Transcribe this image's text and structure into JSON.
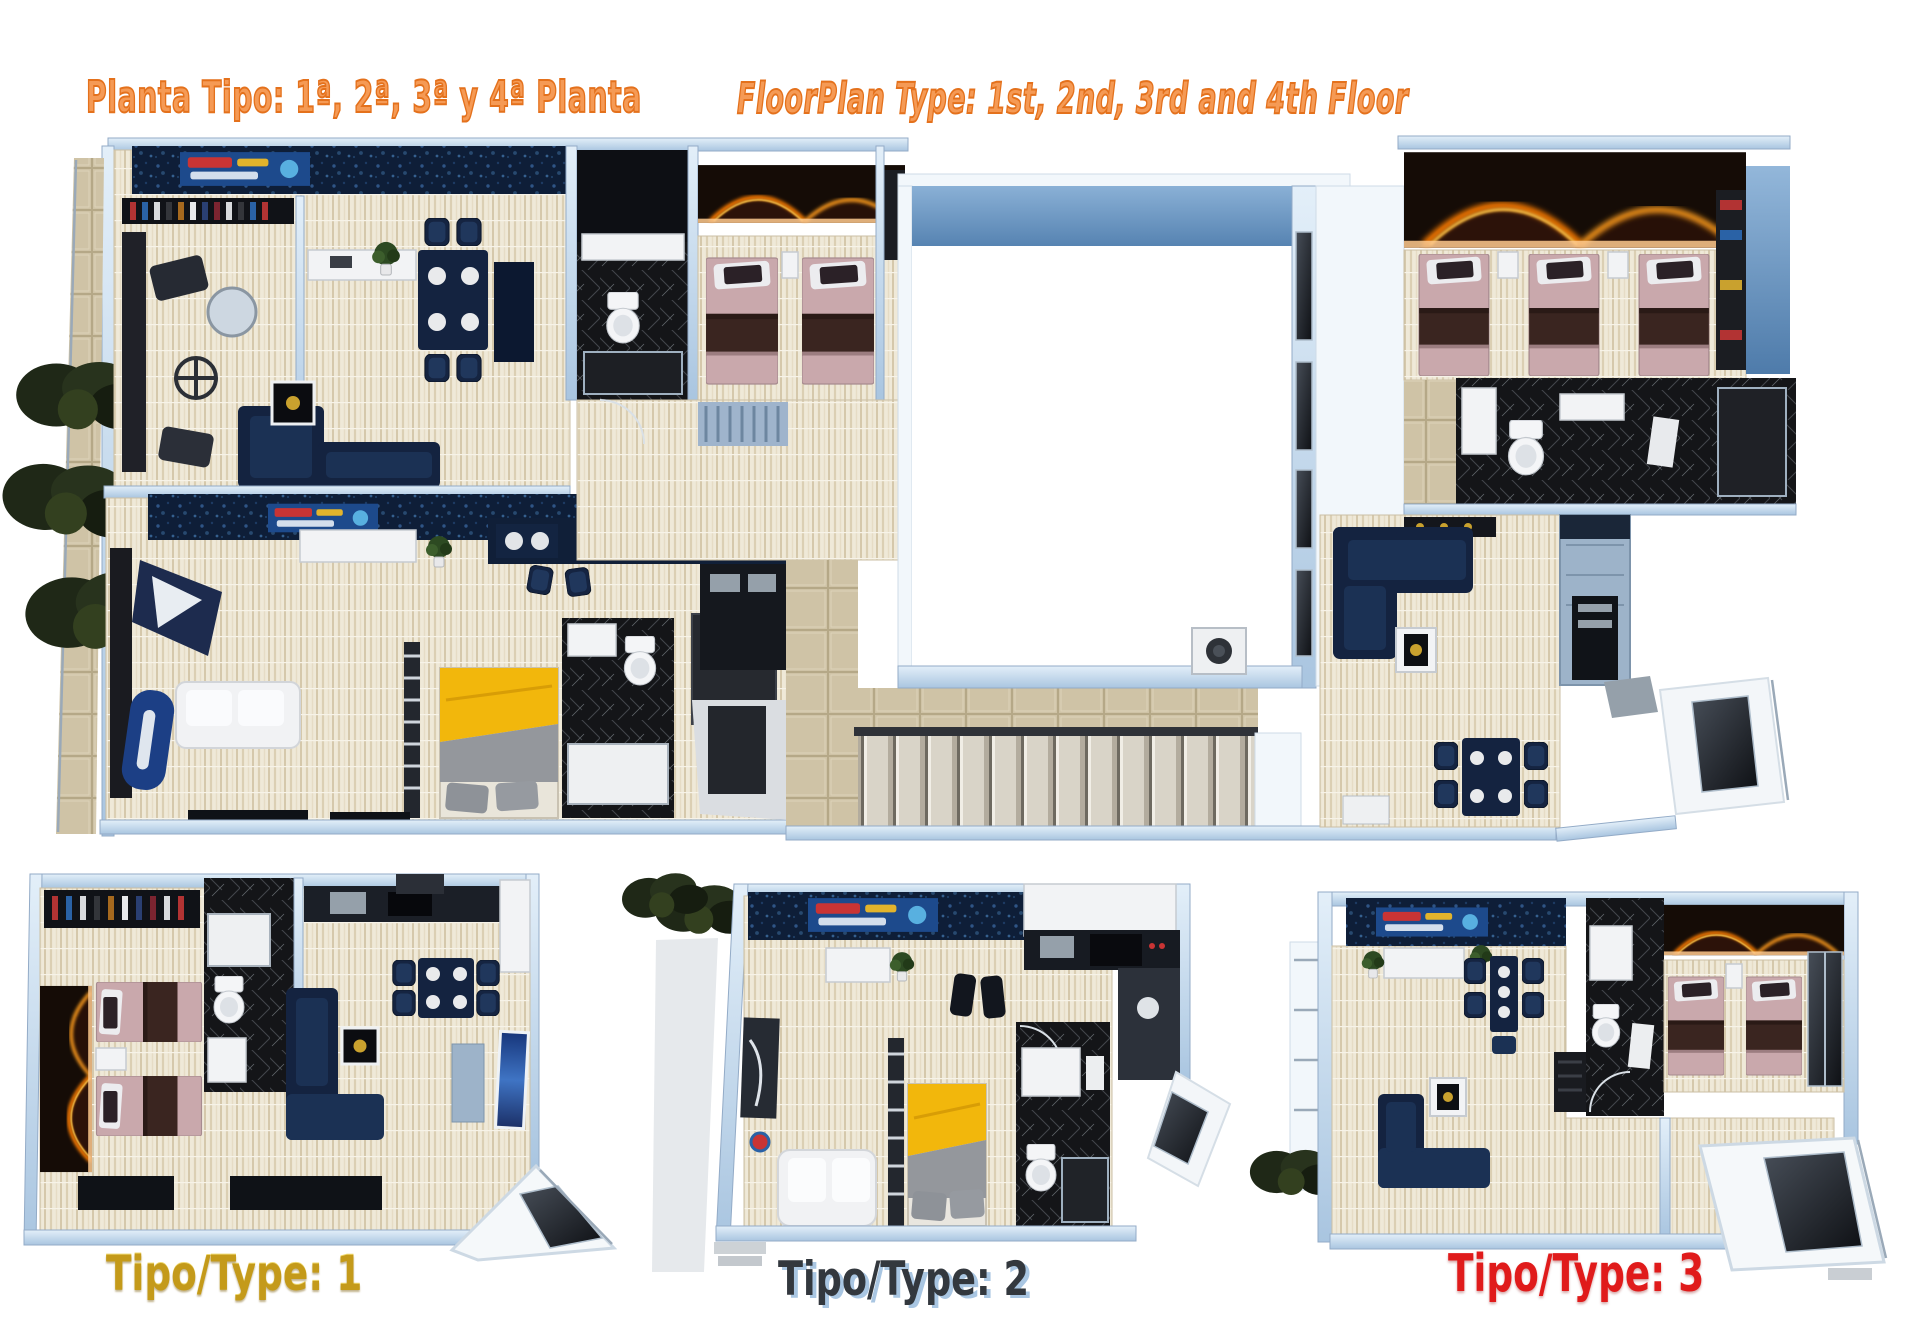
{
  "header": {
    "title_es": "Planta Tipo: 1ª, 2ª, 3ª y 4ª Planta",
    "title_en": "FloorPlan Type: 1st, 2nd, 3rd and 4th Floor"
  },
  "plans": {
    "type1": {
      "label": "Tipo/Type: 1",
      "label_color": "#c49a1a"
    },
    "type2": {
      "label": "Tipo/Type: 2",
      "label_color": "#33383e",
      "label_shadow": "#a9c6e2"
    },
    "type3": {
      "label": "Tipo/Type: 3",
      "label_color": "#e01b1b"
    }
  },
  "colors": {
    "title_orange_stroke": "#e4711c",
    "title_orange_fill": "#f59a55",
    "wall_light_blue": "#cfe2f3",
    "floor_beige": "#efe9d8",
    "tile_tan": "#cfc3a6",
    "furniture_navy": "#142340",
    "accent_wall_navy": "#0e1e38",
    "fire_led_orange": "#ff7e00",
    "bed_pink": "#c9a8ac",
    "bed_blanket_brown": "#3a2520",
    "bed_yellow": "#f2b70c",
    "bathroom_black": "#141518",
    "fixture_white": "#f2f3f5",
    "courtyard_band_blue": "#6f9cc9",
    "sofa_white": "#f1f2f4",
    "tree_green": "#222b1a",
    "stair_tread": "#d9d4c8"
  }
}
